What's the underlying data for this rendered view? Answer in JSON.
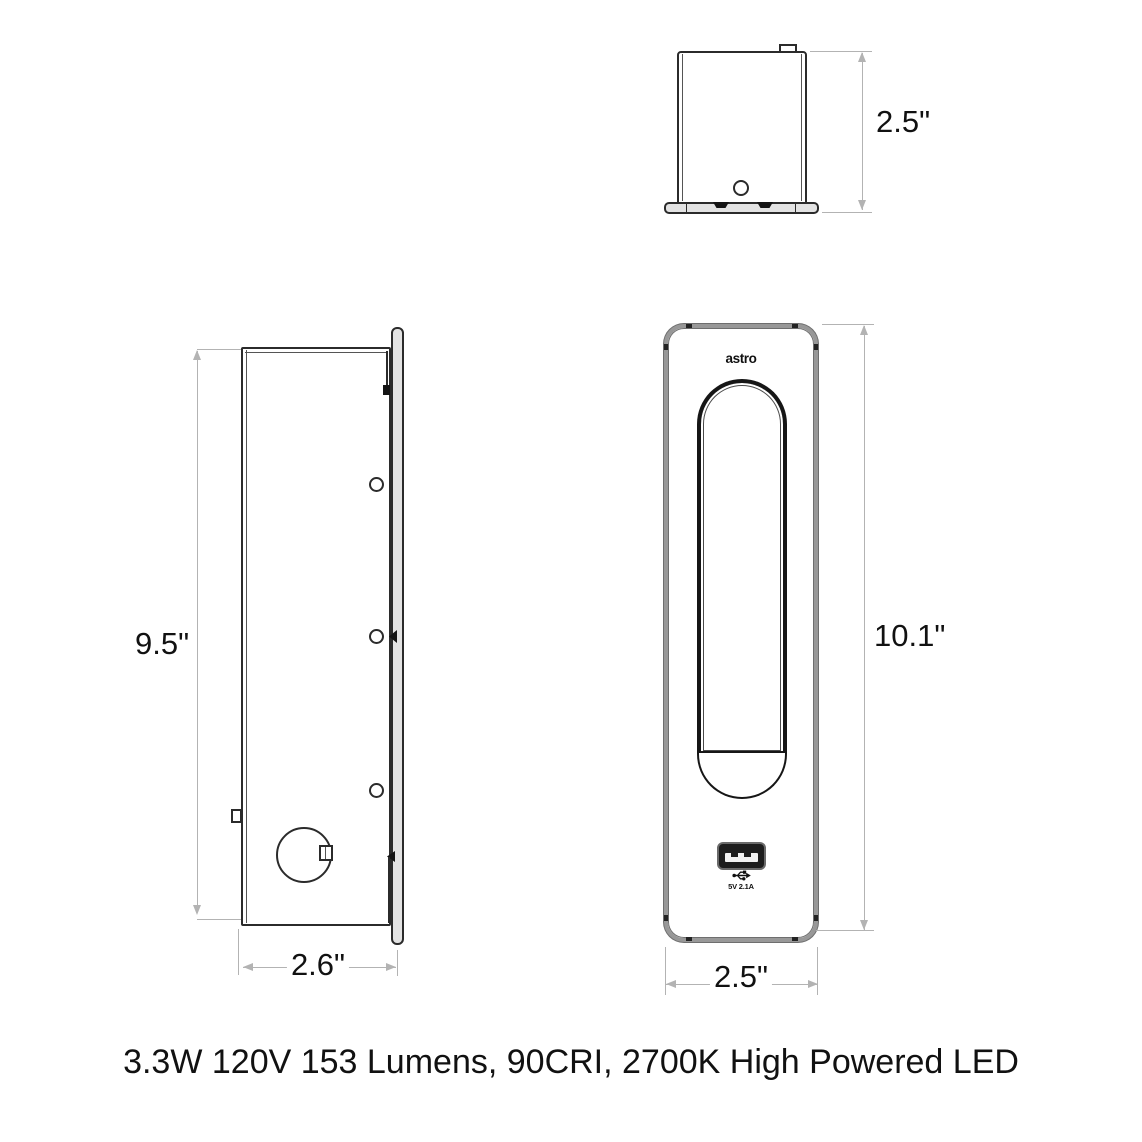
{
  "caption": "3.3W 120V 153 Lumens, 90CRI, 2700K High Powered LED",
  "views": {
    "top": {
      "depth_label": "2.5\""
    },
    "side": {
      "height_label": "9.5\"",
      "depth_label": "2.6\""
    },
    "front": {
      "brand_logo": "astro",
      "height_label": "10.1\"",
      "width_label": "2.5\"",
      "usb_rating": "5V 2.1A",
      "usb_icon": "usb-trident-icon"
    }
  },
  "colors": {
    "background": "#ffffff",
    "line": "#2b2b2b",
    "thin_line": "#555555",
    "dim_line": "#b3b3b3",
    "label": "#111111",
    "plate_fill": "#e3e3e3",
    "frame_gray": "#989898",
    "usb_dark": "#1d1d1d"
  }
}
